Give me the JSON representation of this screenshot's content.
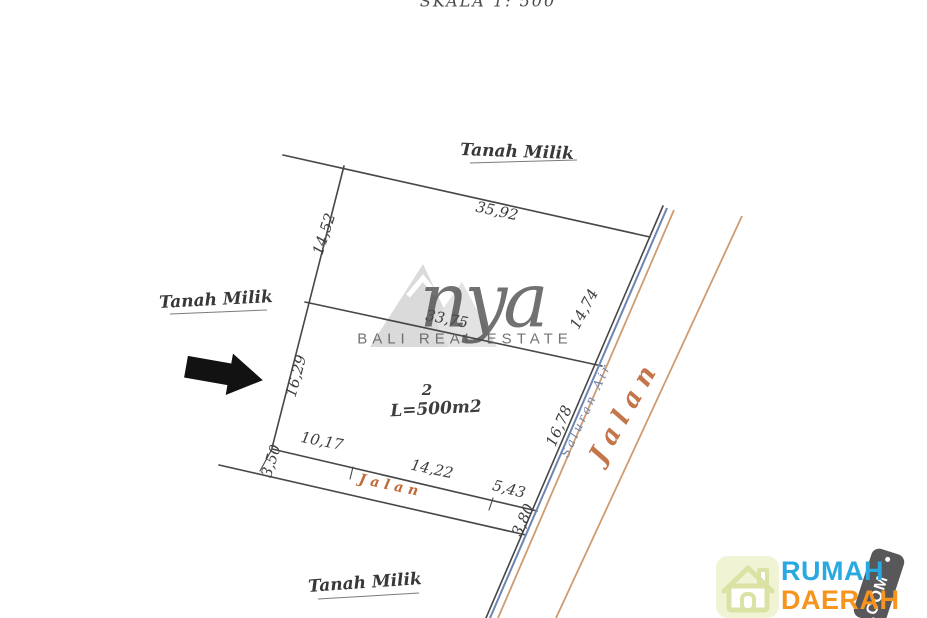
{
  "scale_note": "SKALA 1: 500",
  "boundaries": {
    "top": "Tanah Milik",
    "left": "Tanah Milik",
    "bottom": "Tanah Milik"
  },
  "plot": {
    "number": "2",
    "area_label": "L=500m2"
  },
  "measurements": {
    "top_edge": "35,92",
    "left_upper": "14,52",
    "right_upper": "14,74",
    "middle_divider": "33,75",
    "left_lower": "16,29",
    "right_lower": "16,78",
    "bottom_segment_1": "10,17",
    "bottom_segment_2": "14,22",
    "bottom_segment_3": "5,43",
    "lane_width_left": "3,50",
    "lane_width_right": "3,80"
  },
  "roads": {
    "lane_label": "Jalan",
    "main_road_label": "Jalan",
    "water_channel_label": "Saluran Air"
  },
  "watermark": {
    "brand_script": "nya",
    "brand_caption": "BALI REAL ESTATE"
  },
  "logo": {
    "word_top": "RUMAH",
    "word_bottom": "DAERAH",
    "tag": ".COM"
  },
  "colors": {
    "line": "#474747",
    "water_channel": "#6e84b2",
    "road_edge": "#cf9c72",
    "road_text": "#c06a38",
    "road_text2": "#c4764a",
    "logo_blue": "#2aa9e1",
    "logo_orange": "#f7941e",
    "tag_gray": "#58585a",
    "house_tile": "#f0f3d4",
    "house_stroke": "#dce2a4"
  }
}
